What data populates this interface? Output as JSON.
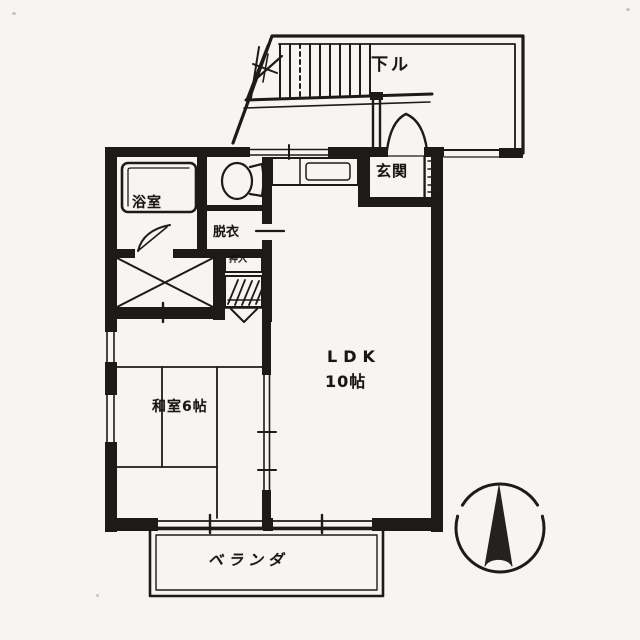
{
  "floorplan": {
    "rooms": {
      "stairs": {
        "label": "下ル"
      },
      "entrance": {
        "label": "玄関"
      },
      "bathroom": {
        "label": "浴室"
      },
      "dressing_room": {
        "label": "脱衣"
      },
      "closet": {
        "label": "押入"
      },
      "ldk": {
        "label": "LDK",
        "size": "10帖"
      },
      "japanese_room": {
        "label": "和室6帖"
      },
      "veranda": {
        "label": "ベランダ"
      }
    },
    "symbols": [
      "north-compass-icon",
      "staircase-icon",
      "entry-door-arc-icon",
      "bathtub-icon",
      "toilet-icon",
      "kitchen-sink-icon",
      "closet-x-icon",
      "hatched-storage-icon",
      "tatami-grid-icon"
    ],
    "colors": {
      "ink": "#1d1b18",
      "paper": "#f6f5f1"
    }
  }
}
